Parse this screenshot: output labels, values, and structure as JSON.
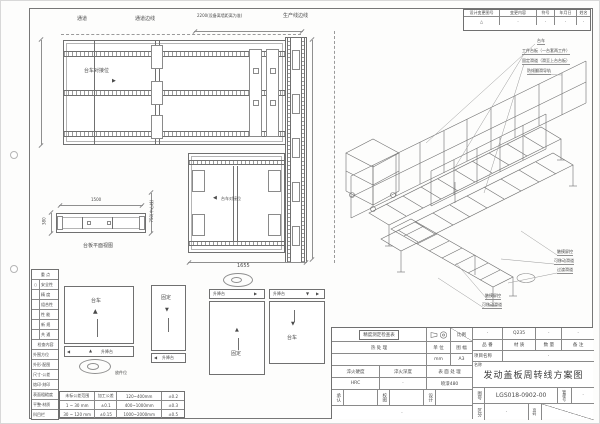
{
  "arrows": {
    "up": "▲",
    "down": "▼",
    "left": "◀",
    "right": "▶"
  },
  "revision": {
    "headers": [
      "设计变更图号",
      "变更内容",
      "符号",
      "年月日",
      "姓名"
    ],
    "values": [
      "△",
      "·",
      "·",
      "·",
      "·"
    ]
  },
  "top_view": {
    "aisle": "通道",
    "aisle_edge": "通道边线",
    "prod_edge": "生产线边线",
    "dim_2200": "2200(设备离墙距离为准)",
    "dim_3800": "3800",
    "dock_label": "台车对接位"
  },
  "mid_view": {
    "dock_label": "台车对接位",
    "dim_1655": "1655",
    "dim_3860": "3860"
  },
  "side_view": {
    "dim_1500": "1500",
    "dim_380": "380",
    "dim_750": "750(中心线)",
    "caption": "台板平面视图"
  },
  "checklist": {
    "rows": [
      {
        "mark": "",
        "label": "重  点"
      },
      {
        "mark": "○",
        "label": "安全性"
      },
      {
        "mark": "",
        "label": "精 度"
      },
      {
        "mark": "",
        "label": "组合性"
      },
      {
        "mark": "",
        "label": "性 能"
      },
      {
        "mark": "",
        "label": "新 规"
      },
      {
        "mark": "",
        "label": "共 通"
      },
      {
        "mark": "",
        "label": "检查内容"
      },
      {
        "mark": "",
        "label": "外围方位"
      },
      {
        "mark": "",
        "label": "外形·配图"
      },
      {
        "mark": "",
        "label": "尺寸·公差"
      },
      {
        "mark": "",
        "label": "烙印·刻印"
      },
      {
        "mark": "",
        "label": "表面粗糙度"
      },
      {
        "mark": "",
        "label": "平整·材质"
      },
      {
        "mark": "",
        "label": "科目栏"
      }
    ]
  },
  "flow": {
    "trolley": "台车",
    "fixed": "固定",
    "lift": "升降台",
    "pick": "放件位"
  },
  "tolerance": {
    "rows": [
      [
        "未标公差范围",
        "加工公差",
        "120~400mm",
        "±0.2"
      ],
      [
        "1 ~ 30 mm",
        "±0.1",
        "400~1000mm",
        "±0.3"
      ],
      [
        "30 ~ 120 mm",
        "±0.15",
        "1000~2000mm",
        "±0.5"
      ]
    ]
  },
  "iso": {
    "callouts_top": [
      "台车",
      "工件台板（一台套两工件）",
      "固定滑道（滑至上台台板）",
      "防倾翻滑导轨"
    ],
    "callouts_right": [
      "触摸屏控",
      "可移动滑道",
      "过渡滑道"
    ],
    "callouts_left": [
      "触摸屏控",
      "可移动滑道"
    ]
  },
  "title_block": {
    "check_table": "精度测定检查表",
    "scale_label": "比例",
    "heat_label": "热 处 理",
    "unit_label": "单 位",
    "unit_value": "mm",
    "sheet_label": "图 幅",
    "sheet_value": "A3",
    "quench_hardness_label": "淬火硬度",
    "quench_hardness_value": "HRC",
    "quench_depth_label": "淬火深度",
    "quench_depth_value": "·",
    "surface_label": "表 面 处 理",
    "surface_value": "喷漆480",
    "approve_label": "承认",
    "check_label": "校图",
    "design_label": "设计",
    "footer_dot": "·",
    "part_no_label": "品 番",
    "part_no_value": "·",
    "material_label": "材 质",
    "material_value": "Q235",
    "qty_label": "数 量",
    "qty_value": "·",
    "remark_label": "备 注",
    "remark_value": "·",
    "project_label": "项目名称",
    "project_value": "·",
    "name_label": "名称",
    "drawing_title": "发动盖板周转线方案图",
    "dwg_no_label": "图号",
    "dwg_no": "LGS018-0902-00",
    "mgmt_label": "管理号",
    "mgmt_value": "·",
    "class_label": "区分",
    "class_value": "·",
    "page_label": "页码"
  }
}
